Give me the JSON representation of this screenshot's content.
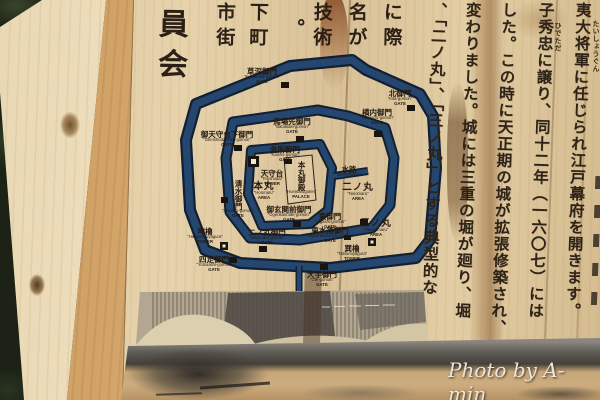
{
  "watermark": "Photo by A-min",
  "sign": {
    "columns": [
      {
        "text": "夷大将軍に任じられ江戸幕府を開きます。",
        "ruby": "たいしょうぐん"
      },
      {
        "text": "子秀忠に譲り、同十二年（一六〇七）には",
        "ruby": "ひでただ"
      },
      {
        "text": "した。この時に天正期の城が拡張修築され、",
        "ruby": ""
      },
      {
        "text": "変わりました。城には三重の堀が廻り、堀",
        "ruby": ""
      },
      {
        "text": "、「二ノ丸」、「三ノ丸」とする典型的な",
        "ruby": ""
      }
    ],
    "top_fragments": [
      "に際",
      "名が",
      "技術",
      "。",
      "下町",
      "市街",
      "員会"
    ]
  },
  "map": {
    "moat_color": "#24466f",
    "icons": [
      "gate-icon",
      "tower-icon",
      "keep-tower-icon"
    ],
    "labels": [
      {
        "jp": "草深御門",
        "en": "\"Kusabuka-gomon\"",
        "type": "GATE"
      },
      {
        "jp": "北御門",
        "en": "\"Kita-gomon\"",
        "type": "GATE"
      },
      {
        "jp": "横内御門",
        "en": "\"Yokouchi-gomon\"",
        "type": "GATE"
      },
      {
        "jp": "馬場先御門",
        "en": "\"Babasaki-gomon\"",
        "type": "GATE"
      },
      {
        "jp": "御天守台下御門",
        "en": "\"Otenshudaishita-gomon\"",
        "type": "GATE"
      },
      {
        "jp": "会所御門",
        "en": "\"Kaisho-gomon\"",
        "type": "GATE"
      },
      {
        "jp": "天守台",
        "en": "\"Tenshudai\"",
        "type": "TOWER"
      },
      {
        "jp": "本丸御殿",
        "en": "\"Honmarugoten\"",
        "type": "PALACE"
      },
      {
        "jp": "本丸",
        "en": "\"Honmaru\"",
        "type": "AREA"
      },
      {
        "jp": "御玄関前御門",
        "en": "\"Ogenkanmae-gomon\"",
        "type": "GATE"
      },
      {
        "jp": "水路",
        "en": "WATERWAY",
        "type": ""
      },
      {
        "jp": "二ノ丸",
        "en": "\"Ninomaru\"",
        "type": "AREA"
      },
      {
        "jp": "東御門",
        "en": "\"Higashi-gomon\"",
        "type": "GATE"
      },
      {
        "jp": "東水落御門",
        "en": "\"Higashimizuochi-gomon\"",
        "type": "GATE"
      },
      {
        "jp": "巽櫓",
        "en": "\"Tatsumiyagura\"",
        "type": "TOWER"
      },
      {
        "jp": "三ノ丸",
        "en": "\"Sannomaru\"",
        "type": "AREA"
      },
      {
        "jp": "二ノ丸御門",
        "en": "\"Ninomaru-gomon\"",
        "type": "GATE"
      },
      {
        "jp": "四足御門",
        "en": "\"Yotsuashi-gomon\"",
        "type": "GATE"
      },
      {
        "jp": "大手御門",
        "en": "\"Ote-gomon\"",
        "type": "GATE"
      },
      {
        "jp": "清水御門",
        "en": "\"Shimizu-gomon\"",
        "type": "GATE"
      },
      {
        "jp": "坤櫓",
        "en": "\"Hitsujisaruyagura\"",
        "type": "TOWER"
      }
    ]
  }
}
